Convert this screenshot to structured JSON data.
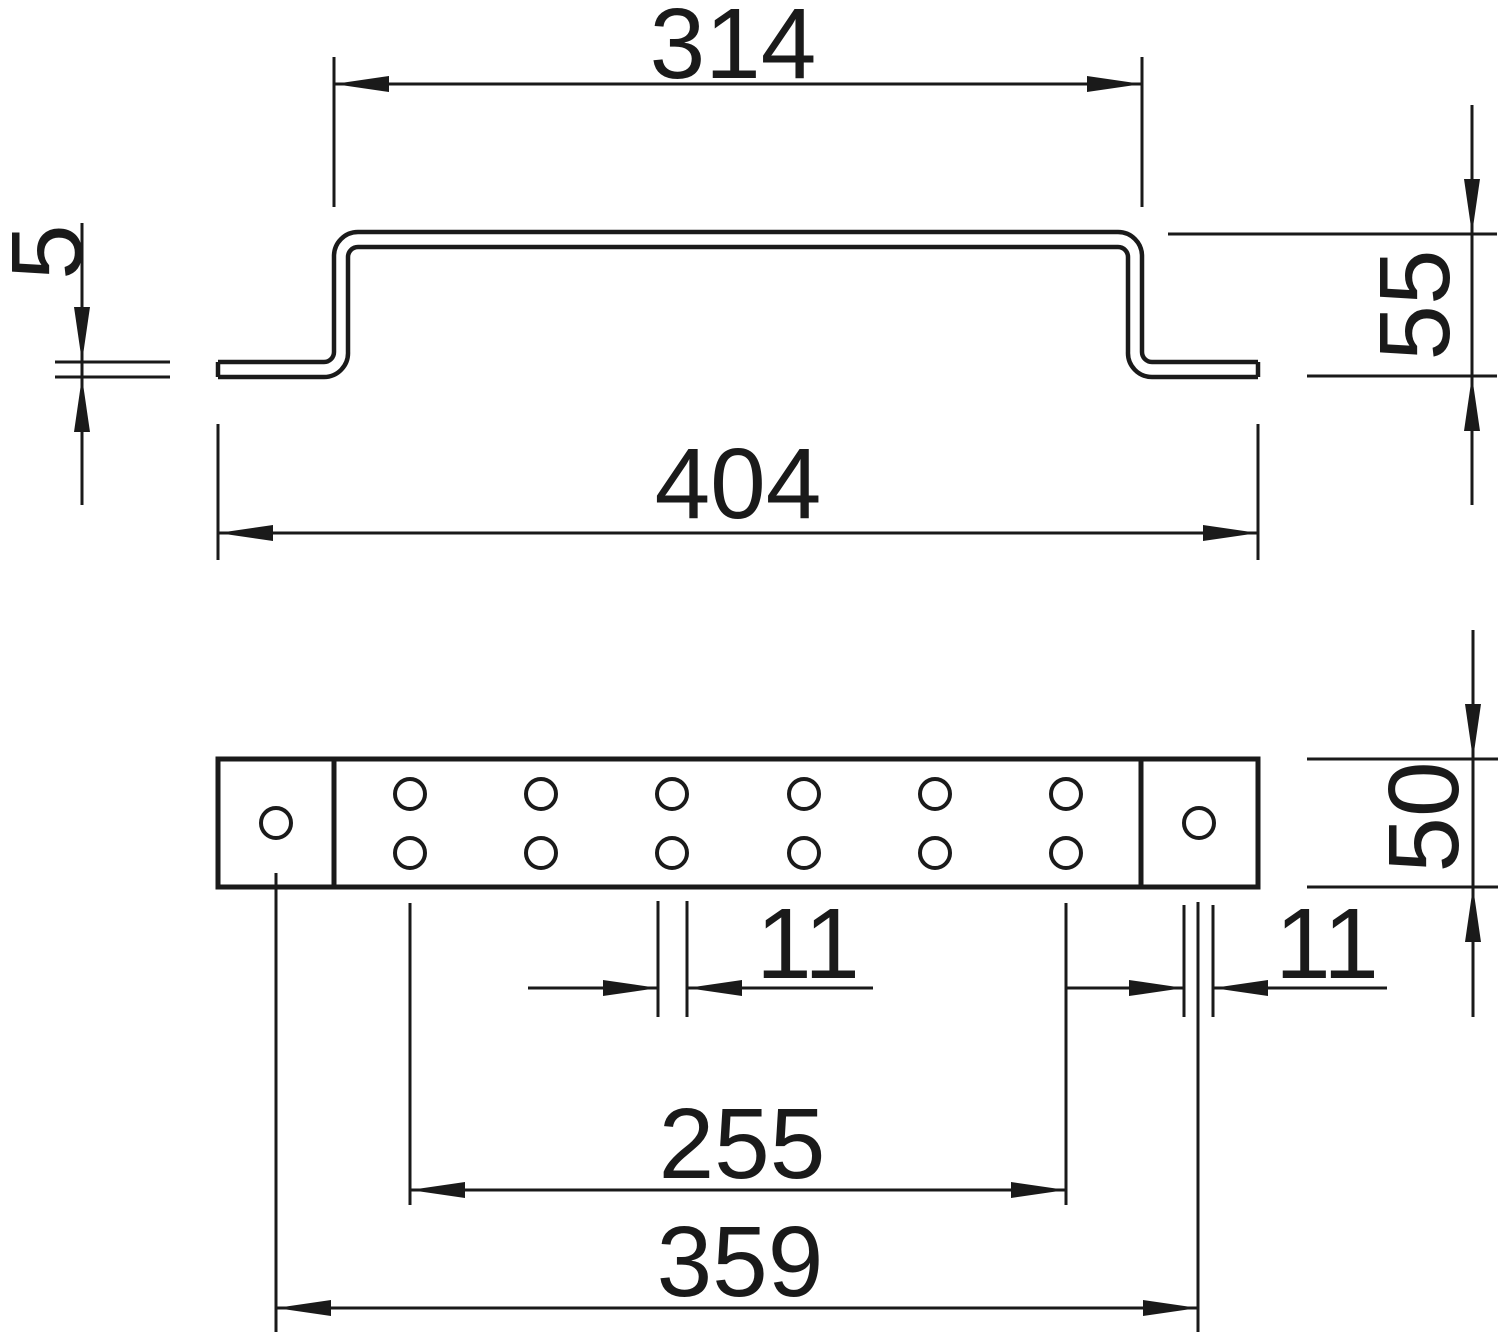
{
  "drawing": {
    "type": "technical-dimension-drawing",
    "colors": {
      "background": "#ffffff",
      "line": "#1a1a1a"
    },
    "profile_view": {
      "description": "side elevation of hat-shaped bent bracket",
      "dims": {
        "top_width": "314",
        "material_thickness": "5",
        "height": "55",
        "overall_width": "404"
      }
    },
    "plan_view": {
      "description": "plan view of bracket with fixing holes",
      "dims": {
        "bar_width": "50",
        "hole_diameter_middle": "11",
        "hole_diameter_end": "11",
        "paired_hole_span": "255",
        "end_hole_span": "359"
      },
      "holes": {
        "end_hole_count": 2,
        "paired_hole_columns": 6,
        "paired_hole_rows": 2
      }
    }
  }
}
